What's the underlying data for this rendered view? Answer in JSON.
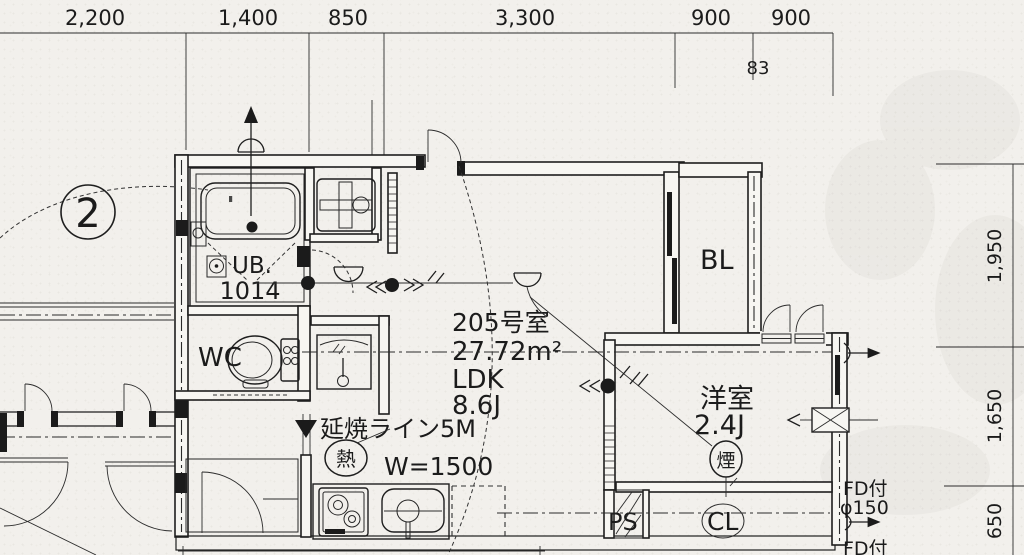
{
  "dims_top": [
    "2,200",
    "1,400",
    "850",
    "3,300",
    "900",
    "900"
  ],
  "dim_sub": "83",
  "dims_right": [
    "1,950",
    "1,650",
    "650"
  ],
  "grid": {
    "bubble": "2"
  },
  "rooms": {
    "ub": "UB.",
    "ub_size": "1014",
    "wc": "WC",
    "unit_no": "205号室",
    "area": "27.72m²",
    "ldk": "LDK",
    "ldk_size": "8.6J",
    "balcony": "BL",
    "western": "洋室",
    "western_size": "2.4J",
    "ps": "PS",
    "cl": "CL"
  },
  "annotations": {
    "fire_line": "延焼ライン5M",
    "heat": "熱",
    "smoke": "煙",
    "kitchen_width": "W=1500",
    "fd_top": "FD付",
    "fd_dia": "φ150",
    "fd_bottom": "FD付"
  }
}
